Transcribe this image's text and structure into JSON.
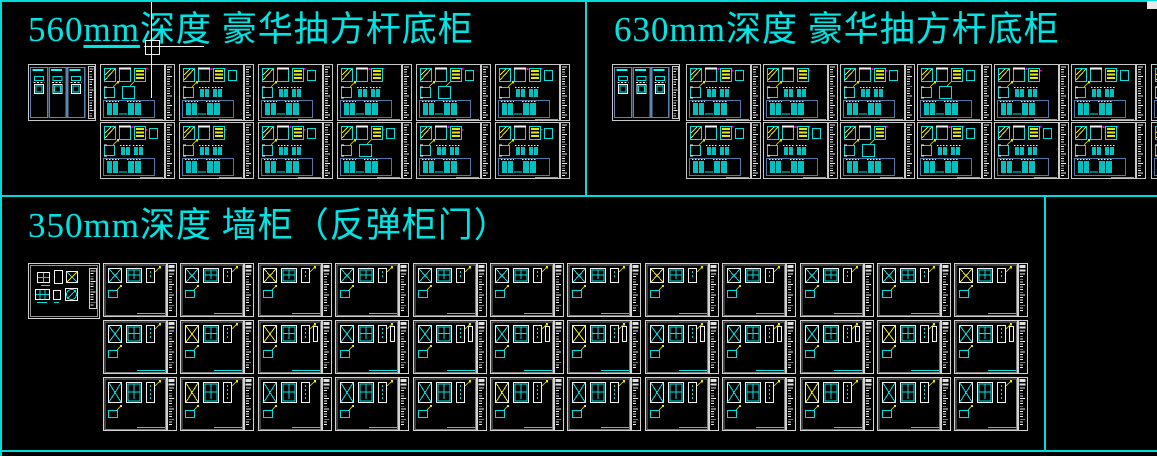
{
  "app": {
    "kind": "cad-drawing-canvas",
    "background": "#000000",
    "border_color": "#00dcdc"
  },
  "colors": {
    "accent_cyan": "#00e2e2",
    "bright_cyan": "#00ffff",
    "entity_yellow": "#e8e800",
    "pencil_olive": "#b0b000",
    "frame_gray": "#c9c9c9",
    "detail_blue": "#4f78ab",
    "marker_magenta": "#ff00ff",
    "cursor_white": "#f0f0f0"
  },
  "cursor": {
    "visible": true,
    "x": 152,
    "y": 47
  },
  "sections": [
    {
      "id": "sec-560",
      "title_num": "560",
      "title_unit": "mm",
      "unit_underlined": true,
      "title_rest": "深度 豪华抽方杆底柜",
      "full_title": "560mm深度 豪华抽方杆底柜",
      "panel_kind": "base-cabinet-drawer-elevation",
      "grid": {
        "rows": 2,
        "cols": 6,
        "index_panel": true
      }
    },
    {
      "id": "sec-630",
      "title_num": "630",
      "title_unit": "mm",
      "unit_underlined": false,
      "title_rest": "深度 豪华抽方杆底柜",
      "full_title": "630mm深度 豪华抽方杆底柜",
      "panel_kind": "base-cabinet-drawer-elevation",
      "grid": {
        "rows": 2,
        "cols": 6,
        "index_panel": true,
        "clipped_extra_column": true
      }
    },
    {
      "id": "sec-350",
      "title_num": "350",
      "title_unit": "mm",
      "unit_underlined": false,
      "title_rest": "深度 墙柜（反弹柜门）",
      "full_title": "350mm深度 墙柜（反弹柜门）",
      "panel_kind": "wall-cabinet-rebound-door-elevation",
      "grid": {
        "rows": 3,
        "cols": 12,
        "index_panel": true
      }
    }
  ]
}
